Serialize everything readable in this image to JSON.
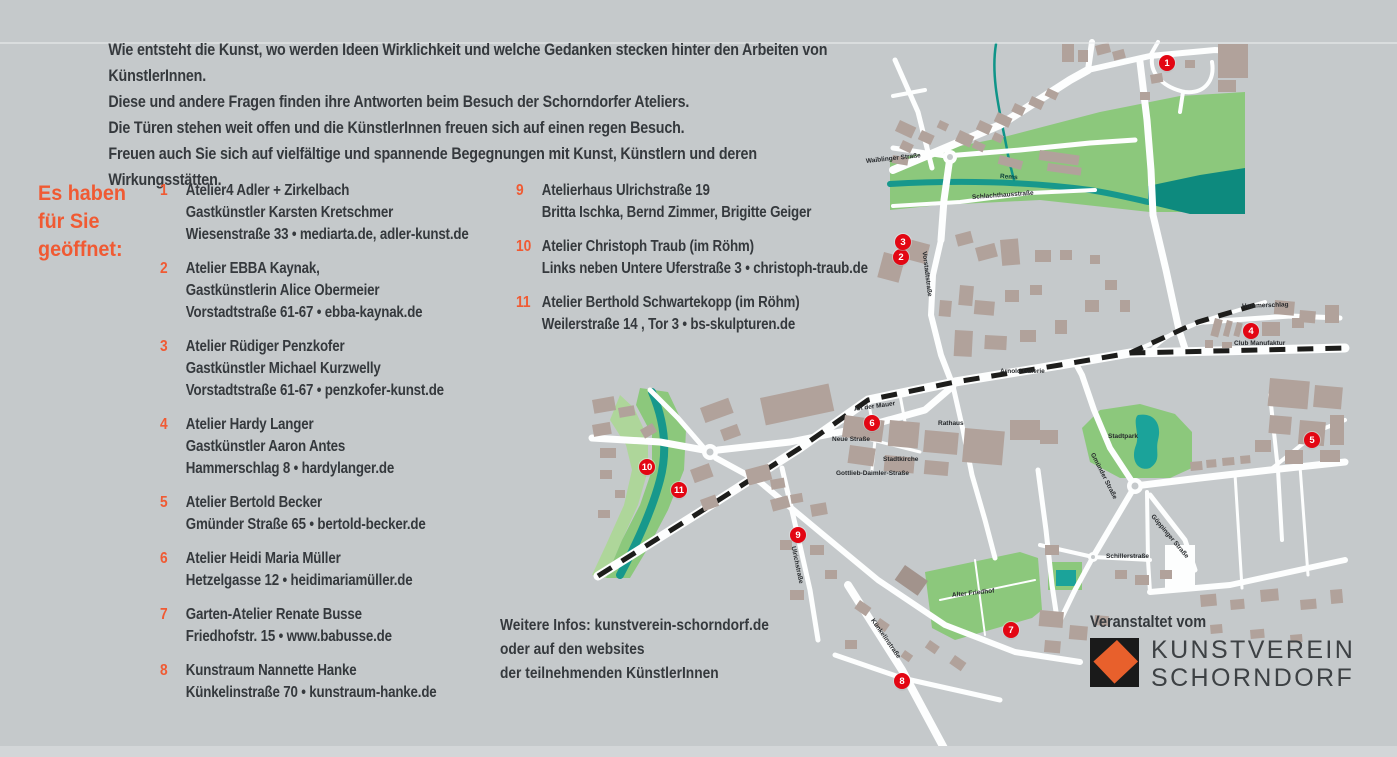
{
  "intro": {
    "text": "Wie entsteht die Kunst, wo werden Ideen Wirklichkeit und welche Gedanken stecken hinter den Arbeiten von KünstlerInnen.\nDiese und andere Fragen finden ihre Antworten beim Besuch der Schorndorfer Ateliers.\nDie Türen stehen weit offen und die KünstlerInnen freuen sich auf einen regen Besuch.\nFreuen auch Sie sich auf vielfältige und spannende Begegnungen mit Kunst, Künstlern und deren Wirkungsstätten."
  },
  "directory": {
    "heading": "Es haben\nfür Sie\ngeöffnet:",
    "items": [
      {
        "num": "1",
        "text": "Atelier4 Adler + Zirkelbach\nGastkünstler Karsten Kretschmer\nWiesenstraße 33 • mediarta.de, adler-kunst.de"
      },
      {
        "num": "2",
        "text": "Atelier EBBA Kaynak,\nGastkünstlerin Alice Obermeier\nVorstadtstraße 61-67 • ebba-kaynak.de"
      },
      {
        "num": "3",
        "text": "Atelier Rüdiger Penzkofer\nGastkünstler Michael Kurzwelly\nVorstadtstraße 61-67 • penzkofer-kunst.de"
      },
      {
        "num": "4",
        "text": "Atelier Hardy Langer\nGastkünstler Aaron Antes\nHammerschlag 8 • hardylanger.de"
      },
      {
        "num": "5",
        "text": "Atelier Bertold Becker\nGmünder Straße 65 • bertold-becker.de"
      },
      {
        "num": "6",
        "text": "Atelier Heidi Maria Müller\nHetzelgasse 12 • heidimariamüller.de"
      },
      {
        "num": "7",
        "text": "Garten-Atelier Renate Busse\nFriedhofstr. 15 • www.babusse.de"
      },
      {
        "num": "8",
        "text": "Kunstraum Nannette Hanke\nKünkelinstraße 70 • kunstraum-hanke.de"
      },
      {
        "num": "9",
        "text": "Atelierhaus Ulrichstraße 19\nBritta Ischka, Bernd Zimmer, Brigitte Geiger"
      },
      {
        "num": "10",
        "text": "Atelier Christoph Traub (im Röhm)\nLinks neben Untere Uferstraße 3 • christoph-traub.de"
      },
      {
        "num": "11",
        "text": "Atelier Berthold Schwartekopp (im Röhm)\nWeilerstraße 14 , Tor 3 • bs-skulpturen.de"
      }
    ]
  },
  "info": {
    "text": "Weitere Infos: kunstverein-schorndorf.de\noder auf den websites\nder teilnehmenden KünstlerInnen"
  },
  "organizer": {
    "label": "Veranstaltet vom",
    "logo_line1": "KUNSTVEREIN",
    "logo_line2": "SCHORNDORF"
  },
  "map": {
    "markers": [
      "1",
      "2",
      "3",
      "4",
      "5",
      "6",
      "7",
      "8",
      "9",
      "10",
      "11"
    ],
    "labels": [
      "Waiblinger Straße",
      "Rems",
      "Schlachthausstraße",
      "Vorstadtstraße",
      "Arnold Galerie",
      "An der Mauer",
      "Neue Straße",
      "Rathaus",
      "Stadtkirche",
      "Gottlieb-Daimler-Straße",
      "Ulrichstraße",
      "Künkelinstraße",
      "Alter Friedhof",
      "Stadtpark",
      "Gmünder Straße",
      "Schillerstraße",
      "Göppinger Straße",
      "Club Manufaktur",
      "Hammerschlag"
    ]
  },
  "colors": {
    "background": "#c5c9cb",
    "accent_orange": "#f05a33",
    "marker_red": "#e30613",
    "park_green": "#8cc87c",
    "river_teal": "#17988c",
    "building_taupe": "#b1a29b",
    "railway_black": "#1d1d1b",
    "text_dark": "#35393d"
  }
}
